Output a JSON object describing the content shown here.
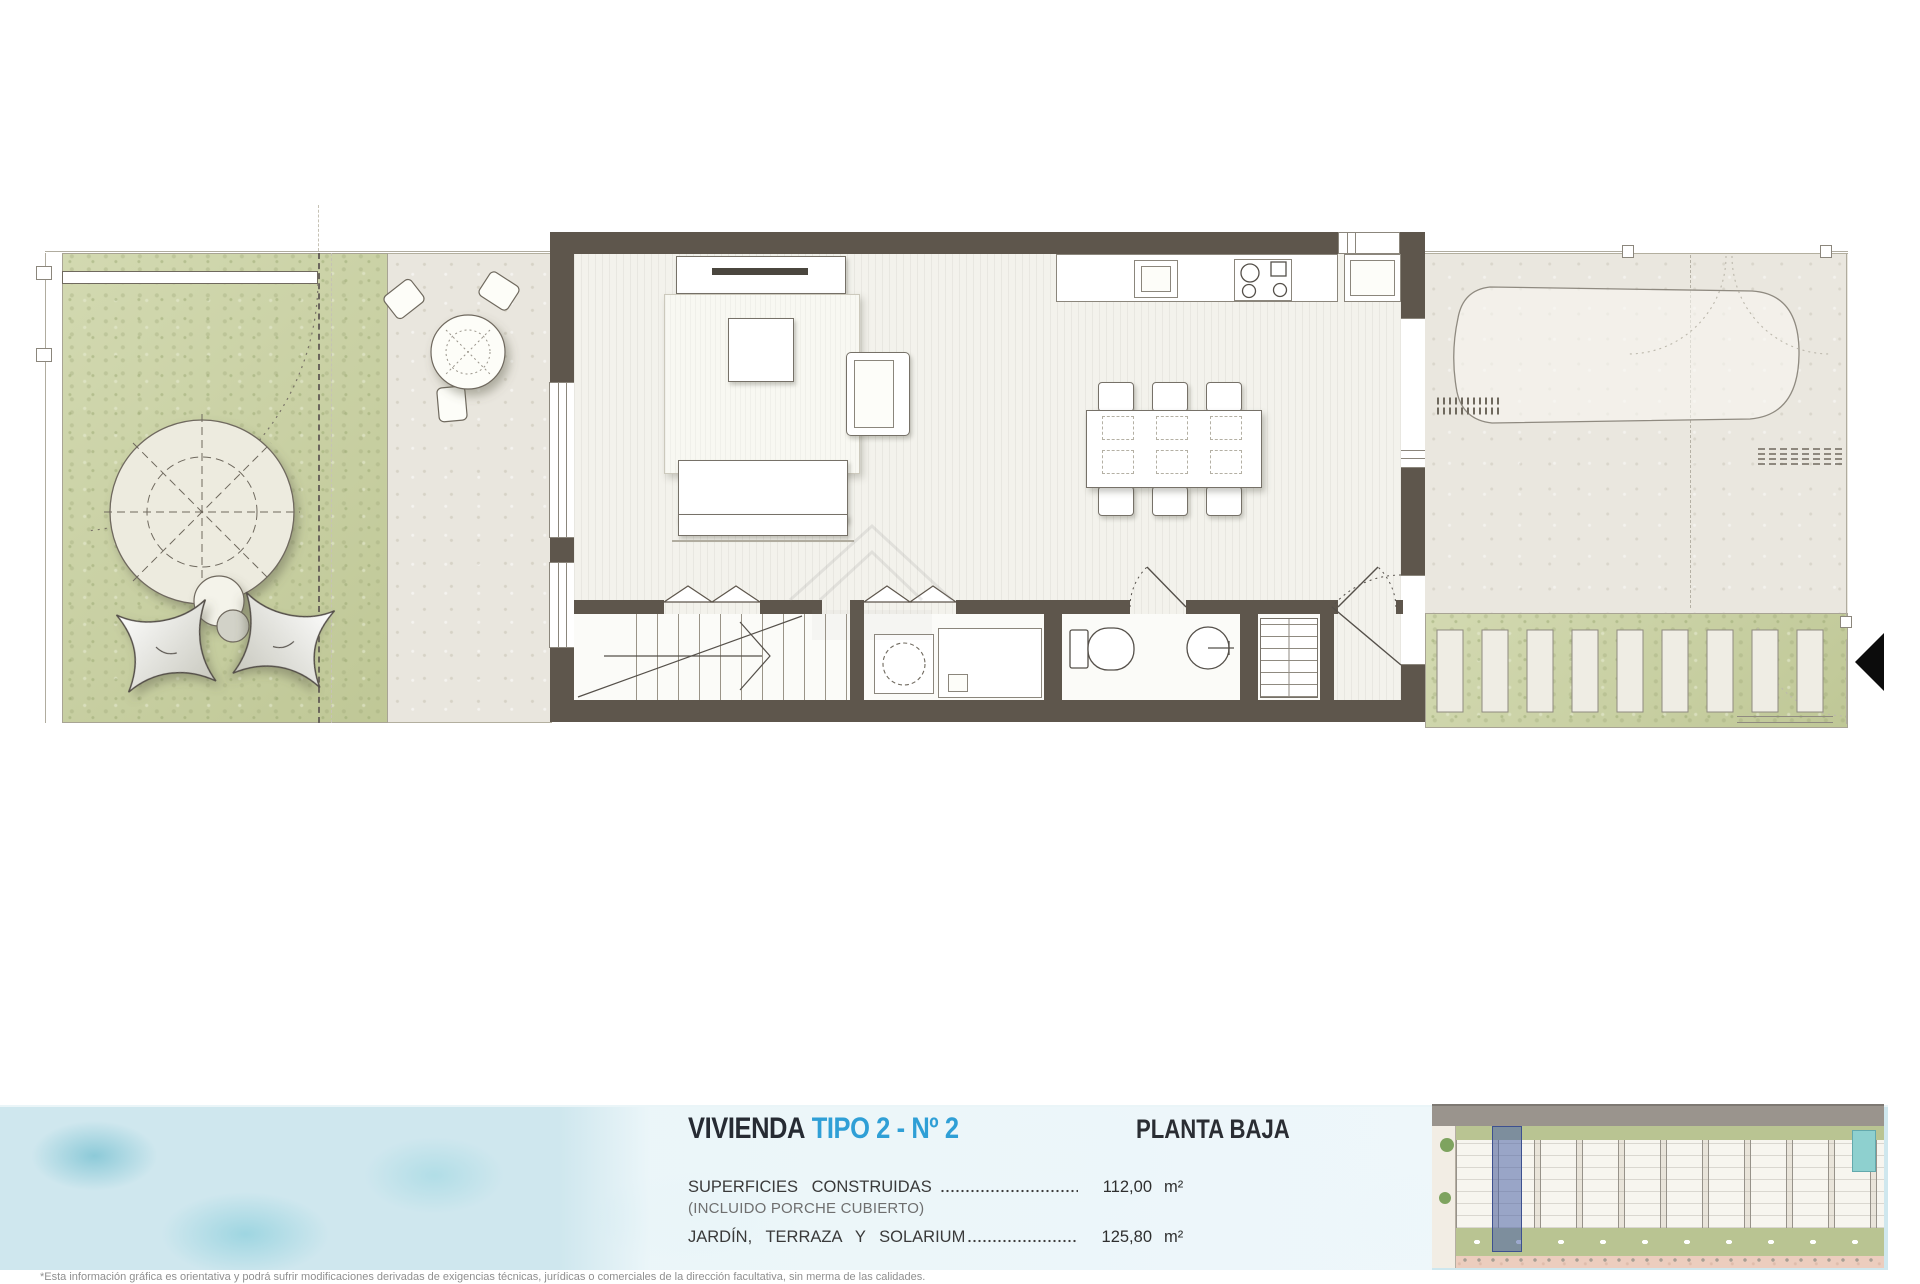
{
  "document": {
    "type": "architectural-floor-plan-sheet",
    "title": {
      "project": "VIVIENDA",
      "unit": "TIPO 2 - Nº 2",
      "floor": "PLANTA BAJA"
    },
    "areas": [
      {
        "label": "SUPERFICIES CONSTRUIDAS",
        "note": "(INCLUIDO PORCHE CUBIERTO)",
        "value": "112,00",
        "unit": "m²"
      },
      {
        "label": "JARDÍN, TERRAZA Y SOLARIUM",
        "note": "",
        "value": "125,80",
        "unit": "m²"
      }
    ],
    "disclaimer": "*Esta información gráfica es orientativa y podrá sufrir modificaciones derivadas de exigencias técnicas, jurídicas o comerciales de la dirección facultativa, sin merma de las calidades."
  },
  "icons": {
    "north_arrow": "compass-north-arrow",
    "entrance_arrow": "entrance-direction-arrow",
    "umbrella": "garden-parasol",
    "site_key": "site-plan-thumbnail"
  },
  "colors": {
    "accent_cyan": "#2f9fd6",
    "title_ink": "#262b33",
    "wall": "#5e564c",
    "grass_green": "#c9d1a0",
    "terrace_beige": "#e9e6de",
    "patio_beige": "#eae7df",
    "water_teal": "#79c7d4",
    "panel_blue": "#ddeef4",
    "site_highlight_blue": "#4d62a6",
    "site_salmon": "#eccdbe",
    "site_road_gray": "#9a948d",
    "site_green": "#b9c492"
  }
}
